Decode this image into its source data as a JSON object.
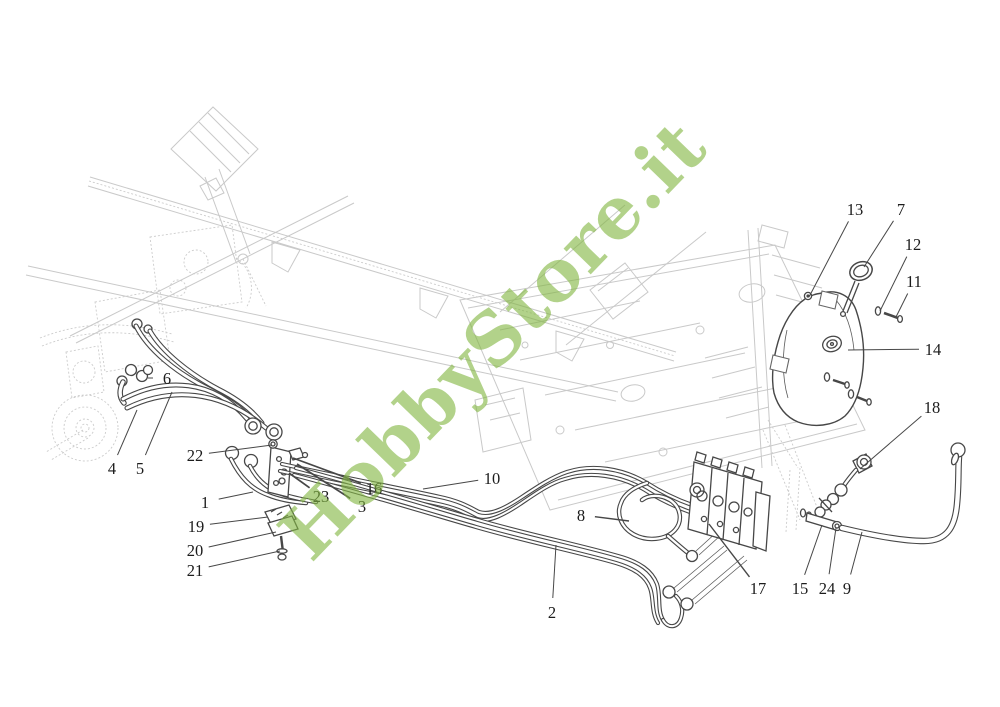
{
  "page": {
    "width": 1000,
    "height": 707,
    "background": "#ffffff"
  },
  "watermark": {
    "text": "HobbyStore.it",
    "color": "#83b742",
    "opacity": 0.62,
    "rotation_deg": -46,
    "center_x": 497,
    "center_y": 344,
    "font_size": 72
  },
  "diagram": {
    "kind": "exploded-parts-diagram",
    "line_color": "#474747",
    "faint_color": "#c9c9c9",
    "label_color": "#1c1c1c",
    "label_font_size": 16.5,
    "callouts": [
      {
        "label": "1",
        "x": 205,
        "y": 502,
        "tx": 253,
        "ty": 492,
        "lw": 1
      },
      {
        "label": "2",
        "x": 552,
        "y": 612,
        "tx": 556,
        "ty": 545,
        "lw": 1
      },
      {
        "label": "3",
        "x": 362,
        "y": 506,
        "tx": 297,
        "ty": 464,
        "lw": 1.7
      },
      {
        "label": "4",
        "x": 112,
        "y": 468,
        "tx": 137,
        "ty": 410,
        "lw": 1
      },
      {
        "label": "5",
        "x": 140,
        "y": 468,
        "tx": 172,
        "ty": 392,
        "lw": 1
      },
      {
        "label": "6",
        "x": 167,
        "y": 378,
        "tx": 148,
        "ty": 378,
        "lw": 1
      },
      {
        "label": "7",
        "x": 901,
        "y": 209,
        "tx": 864,
        "ty": 267,
        "lw": 1
      },
      {
        "label": "8",
        "x": 581,
        "y": 515,
        "tx": 629,
        "ty": 521,
        "lw": 1.4
      },
      {
        "label": "9",
        "x": 847,
        "y": 588,
        "tx": 862,
        "ty": 532,
        "lw": 1
      },
      {
        "label": "10",
        "x": 492,
        "y": 478,
        "tx": 423,
        "ty": 489,
        "lw": 1
      },
      {
        "label": "11",
        "x": 914,
        "y": 281,
        "tx": 896,
        "ty": 317,
        "lw": 1
      },
      {
        "label": "12",
        "x": 913,
        "y": 244,
        "tx": 880,
        "ty": 311,
        "lw": 1
      },
      {
        "label": "13",
        "x": 855,
        "y": 209,
        "tx": 809,
        "ty": 297,
        "lw": 1
      },
      {
        "label": "14",
        "x": 933,
        "y": 349,
        "tx": 848,
        "ty": 350,
        "lw": 1
      },
      {
        "label": "15",
        "x": 800,
        "y": 588,
        "tx": 822,
        "ty": 525,
        "lw": 1
      },
      {
        "label": "16",
        "x": 374,
        "y": 488,
        "tx": 293,
        "ty": 458,
        "lw": 1.7
      },
      {
        "label": "17",
        "x": 758,
        "y": 588,
        "tx": 709,
        "ty": 524,
        "lw": 1.4
      },
      {
        "label": "18",
        "x": 932,
        "y": 407,
        "tx": 860,
        "ty": 469,
        "lw": 1
      },
      {
        "label": "19",
        "x": 196,
        "y": 526,
        "tx": 268,
        "ty": 517,
        "lw": 1
      },
      {
        "label": "20",
        "x": 195,
        "y": 550,
        "tx": 276,
        "ty": 532,
        "lw": 1
      },
      {
        "label": "21",
        "x": 195,
        "y": 570,
        "tx": 280,
        "ty": 551,
        "lw": 1
      },
      {
        "label": "22",
        "x": 195,
        "y": 455,
        "tx": 272,
        "ty": 445,
        "lw": 1
      },
      {
        "label": "23",
        "x": 321,
        "y": 496,
        "tx": 289,
        "ty": 473,
        "lw": 1.7
      },
      {
        "label": "24",
        "x": 827,
        "y": 588,
        "tx": 836,
        "ty": 528,
        "lw": 1
      }
    ]
  }
}
